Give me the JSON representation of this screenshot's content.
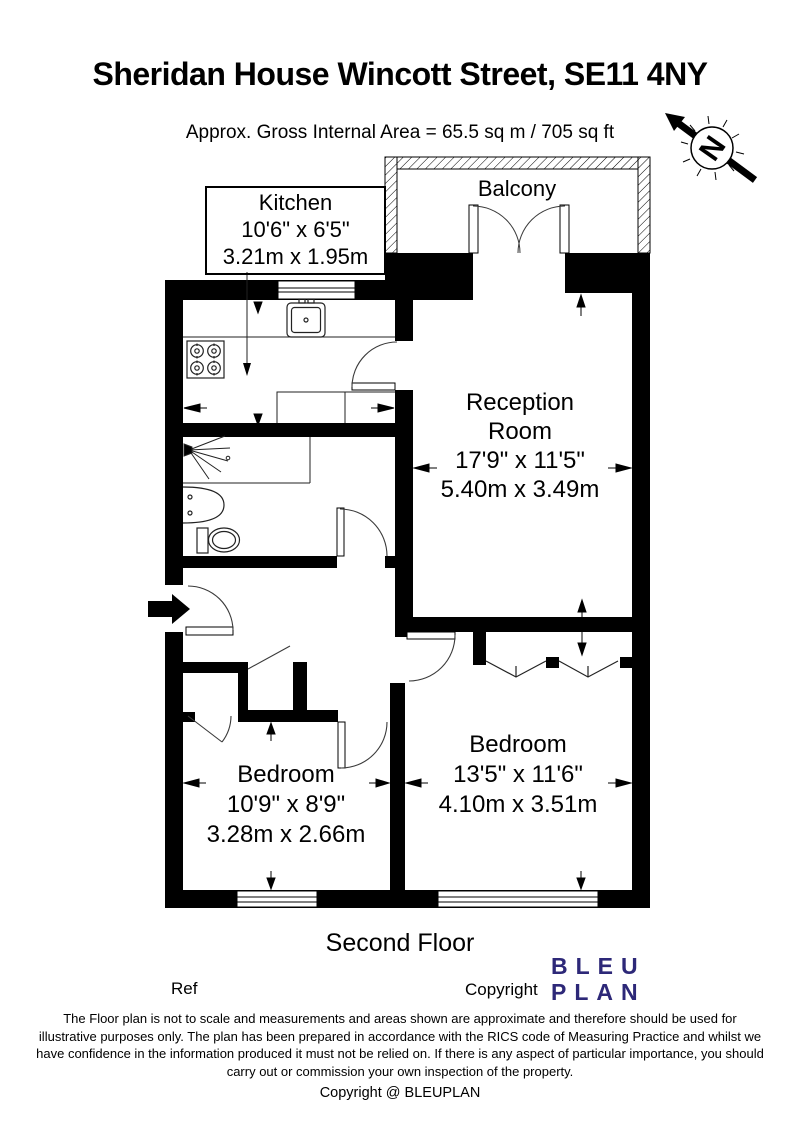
{
  "title": "Sheridan House Wincott Street, SE11 4NY",
  "subtitle": "Approx. Gross Internal Area = 65.5 sq m / 705 sq ft",
  "north": {
    "label": "N"
  },
  "plan": {
    "floor_label": "Second Floor",
    "balcony": {
      "name": "Balcony"
    },
    "kitchen": {
      "name": "Kitchen",
      "size_imperial": "10'6\" x 6'5\"",
      "size_metric": "3.21m x 1.95m"
    },
    "reception": {
      "name_line1": "Reception",
      "name_line2": "Room",
      "size_imperial": "17'9\" x 11'5\"",
      "size_metric": "5.40m x 3.49m"
    },
    "bedroom_left": {
      "name": "Bedroom",
      "size_imperial": "10'9\" x 8'9\"",
      "size_metric": "3.28m x 2.66m"
    },
    "bedroom_right": {
      "name": "Bedroom",
      "size_imperial": "13'5\" x 11'6\"",
      "size_metric": "4.10m x 3.51m"
    }
  },
  "footer": {
    "ref_label": "Ref",
    "copyright_label": "Copyright",
    "logo": {
      "line1": "BLEU",
      "line2": "PLAN",
      "color": "#2d2878"
    },
    "disclaimer_lines": [
      "The Floor plan is not to scale and measurements and areas shown are approximate and therefore should be used for",
      "illustrative purposes only. The plan has been prepared in accordance with the RICS code of Measuring Practice and whilst we",
      "have confidence in the information produced it must not be relied on. If there is any aspect of particular importance, you should",
      "carry out or commission your own inspection of the property."
    ],
    "copyright_line": "Copyright @ BLEUPLAN"
  }
}
